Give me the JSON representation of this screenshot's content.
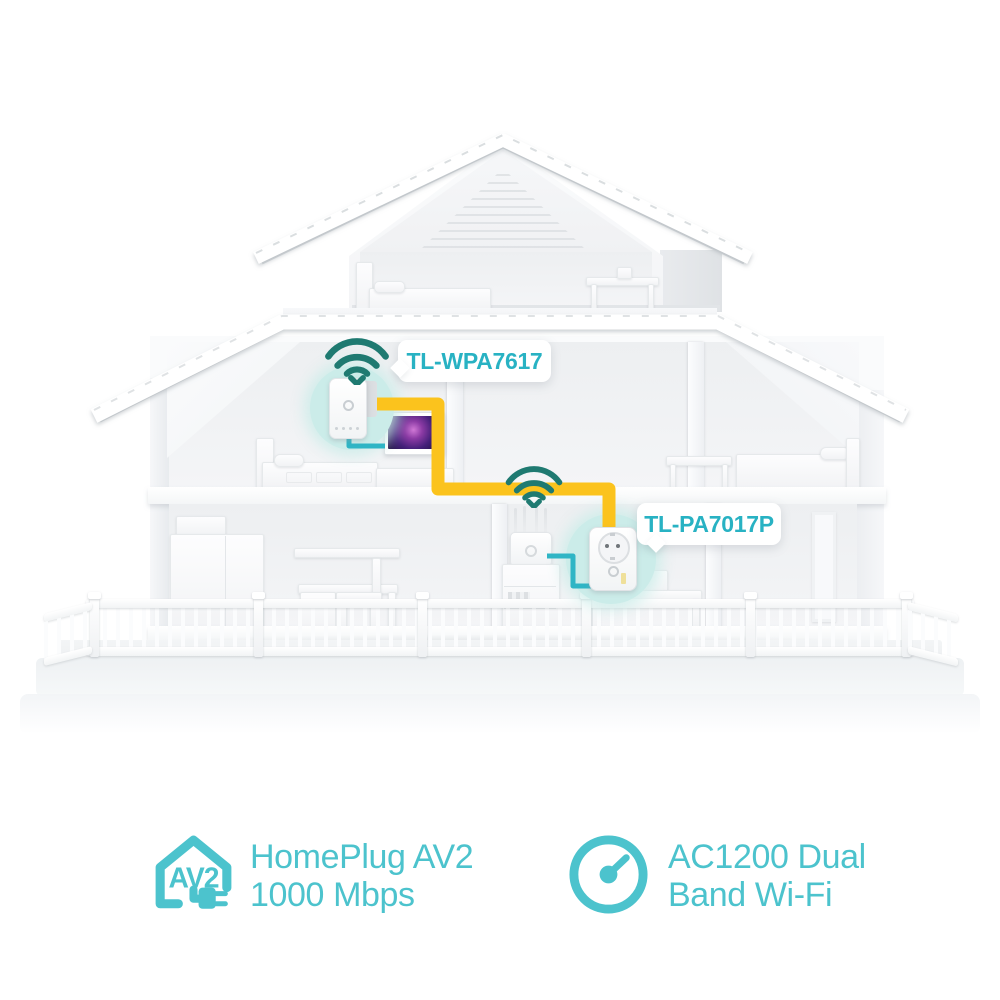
{
  "scene": {
    "type": "product-network-diagram",
    "devices": [
      "wifi-extender-device",
      "powerline-adapter-device",
      "router-device",
      "tv-device"
    ],
    "icons": [
      "wifi-signal-icon",
      "av2-house-plug-icon",
      "speedometer-icon"
    ]
  },
  "callouts": {
    "extender": {
      "label": "TL-WPA7617"
    },
    "adapter": {
      "label": "TL-PA7017P"
    }
  },
  "features": {
    "homeplug": {
      "icon": "av2-house-plug-icon",
      "badge_text": "AV2",
      "line1": "HomePlug AV2",
      "line2": "1000 Mbps"
    },
    "wifi": {
      "icon": "speedometer-icon",
      "line1": "AC1200 Dual",
      "line2": "Band Wi-Fi"
    }
  },
  "colors": {
    "accent_teal": "#4CC3CD",
    "callout_text_teal": "#28B2C3",
    "wifi_icon_teal": "#1F7A71",
    "powerline_cable_yellow": "#FBC31D",
    "ethernet_cable_cyan": "#2FB5C5",
    "device_halo_teal": "#CBECE9",
    "background": "#FFFFFF"
  }
}
